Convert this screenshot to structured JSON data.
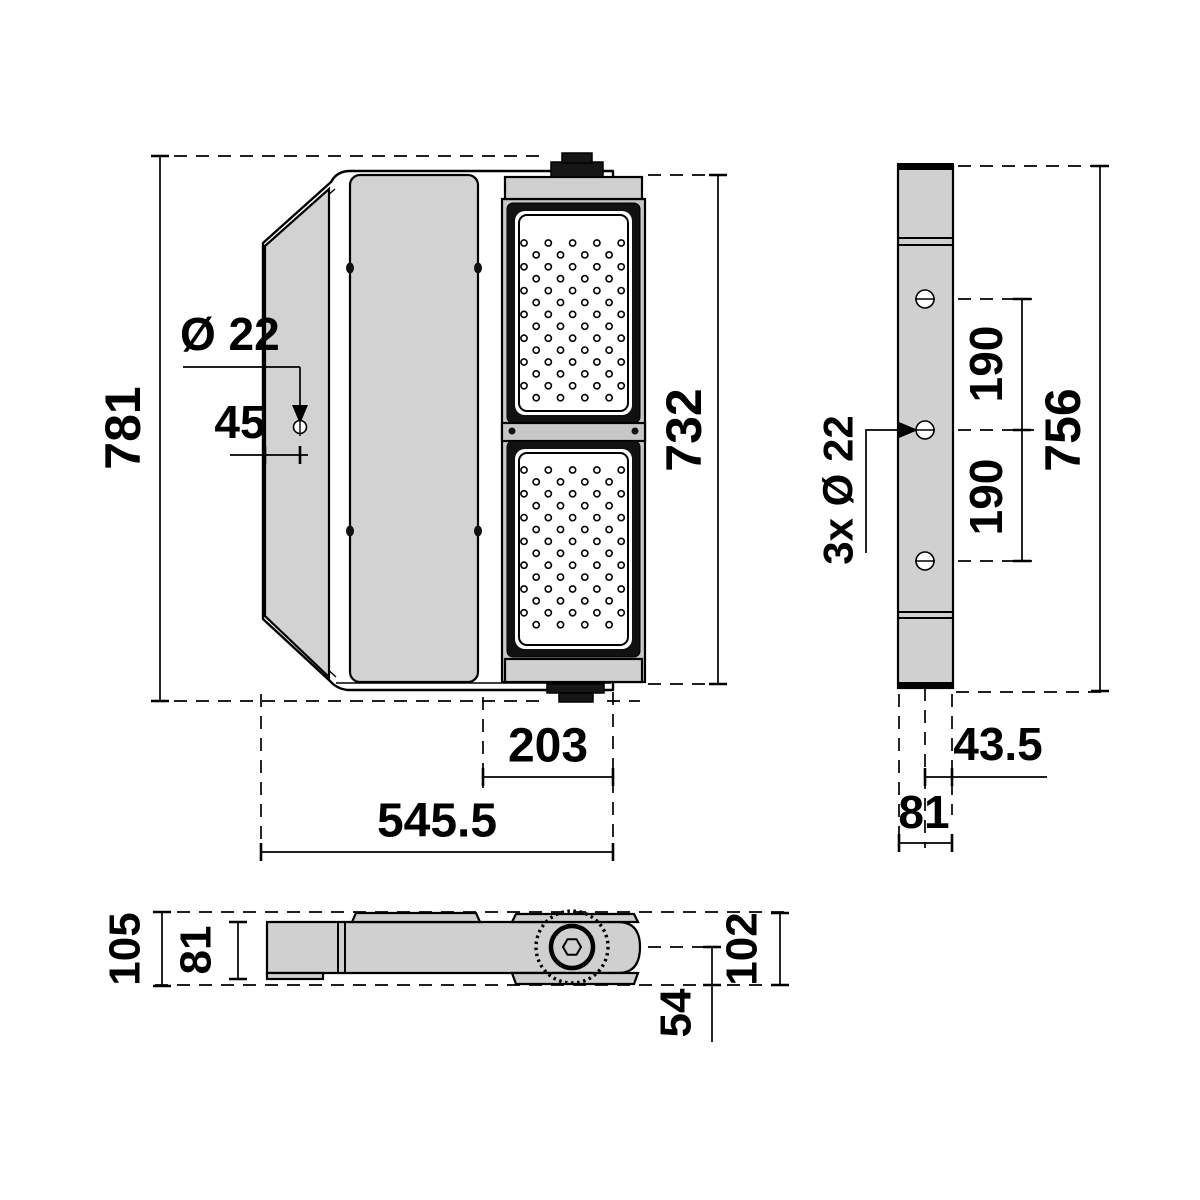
{
  "drawing": {
    "type": "technical-dimension-drawing",
    "views": {
      "front": "front-view",
      "side": "side-view",
      "bottom": "bottom-view"
    }
  },
  "dimensions": {
    "front": {
      "height": "781",
      "module_height": "732",
      "hole_diameter": "Ø 22",
      "hole_offset": "45",
      "module_width": "203",
      "width": "545.5"
    },
    "side": {
      "height": "756",
      "hole_spacing_upper": "190",
      "hole_spacing_lower": "190",
      "holes_note": "3x Ø 22",
      "center_to_edge": "43.5",
      "depth": "81"
    },
    "bottom": {
      "overall_depth": "105",
      "body_depth": "81",
      "bracket_height": "102",
      "pivot_to_edge": "54"
    }
  }
}
